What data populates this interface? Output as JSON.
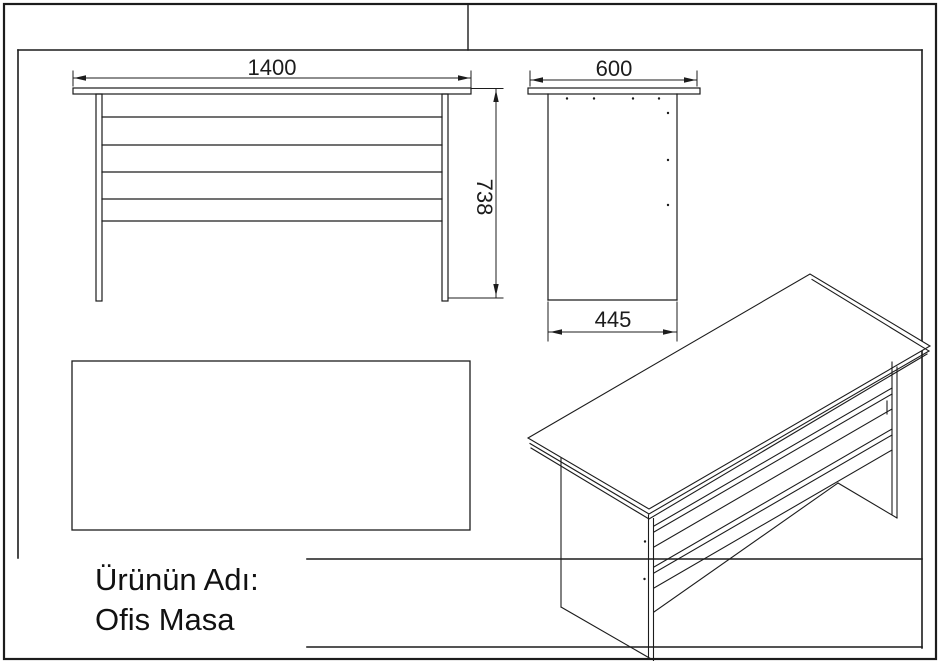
{
  "drawing": {
    "front_view": {
      "width_dimension": "1400",
      "height_dimension": "738"
    },
    "side_view": {
      "top_dimension": "600",
      "bottom_dimension": "445"
    },
    "title_block": {
      "label": "Ürünün Adı:",
      "product_name": "Ofis Masa"
    }
  },
  "colors": {
    "background": "#ffffff",
    "line": "#1c1c1c",
    "text": "#111111"
  }
}
